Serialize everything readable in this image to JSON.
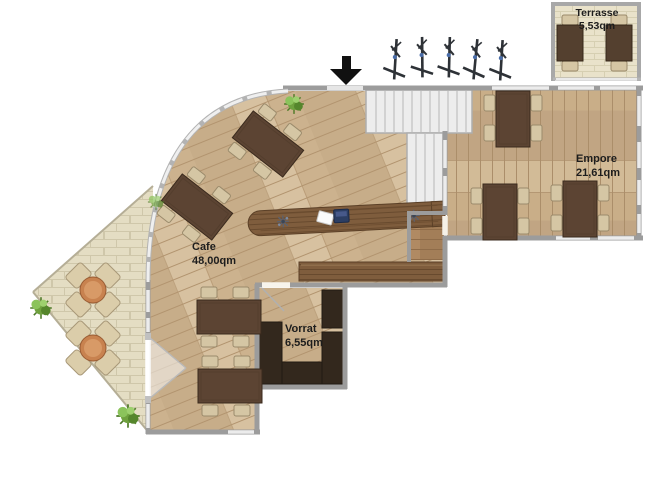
{
  "rooms": [
    {
      "name": "Cafe",
      "area": "48,00qm"
    },
    {
      "name": "Empore",
      "area": "21,61qm"
    },
    {
      "name": "Vorrat",
      "area": "6,55qm"
    },
    {
      "name": "Terrasse",
      "area": "5,53qm"
    }
  ],
  "furniture": {
    "cafe_tables": 4,
    "empore_tables": 3,
    "terrace_tables": 2,
    "patio_table_groups": 2,
    "bar_counter": 1,
    "staircase": 1
  },
  "icons": [
    {
      "name": "entrance-arrow-icon",
      "glyph": "▼"
    },
    {
      "name": "outdoor-plant-icon",
      "glyph": "sapling"
    },
    {
      "name": "indoor-plant-icon",
      "glyph": "bush"
    },
    {
      "name": "cash-register-icon",
      "glyph": "box"
    },
    {
      "name": "menu-card-icon",
      "glyph": "card"
    },
    {
      "name": "flower-vase-icon",
      "glyph": "star"
    }
  ],
  "colors": {
    "wood_floor": "#cfb795",
    "wood_floor_empore": "#c9ae88",
    "paving": "#e4ddc3",
    "wall": "#9c9c9c",
    "window": "#ececec",
    "table_dark": "#5c4433",
    "chair_tan": "#d5c6a4",
    "counter_wood": "#7f5d3d",
    "shelf_dark": "#33281d",
    "stairs": "#ededed",
    "plant_green": "#6fa13e",
    "round_table": "#c8824f",
    "register_blue": "#2c3e63",
    "arrow_black": "#111111"
  }
}
